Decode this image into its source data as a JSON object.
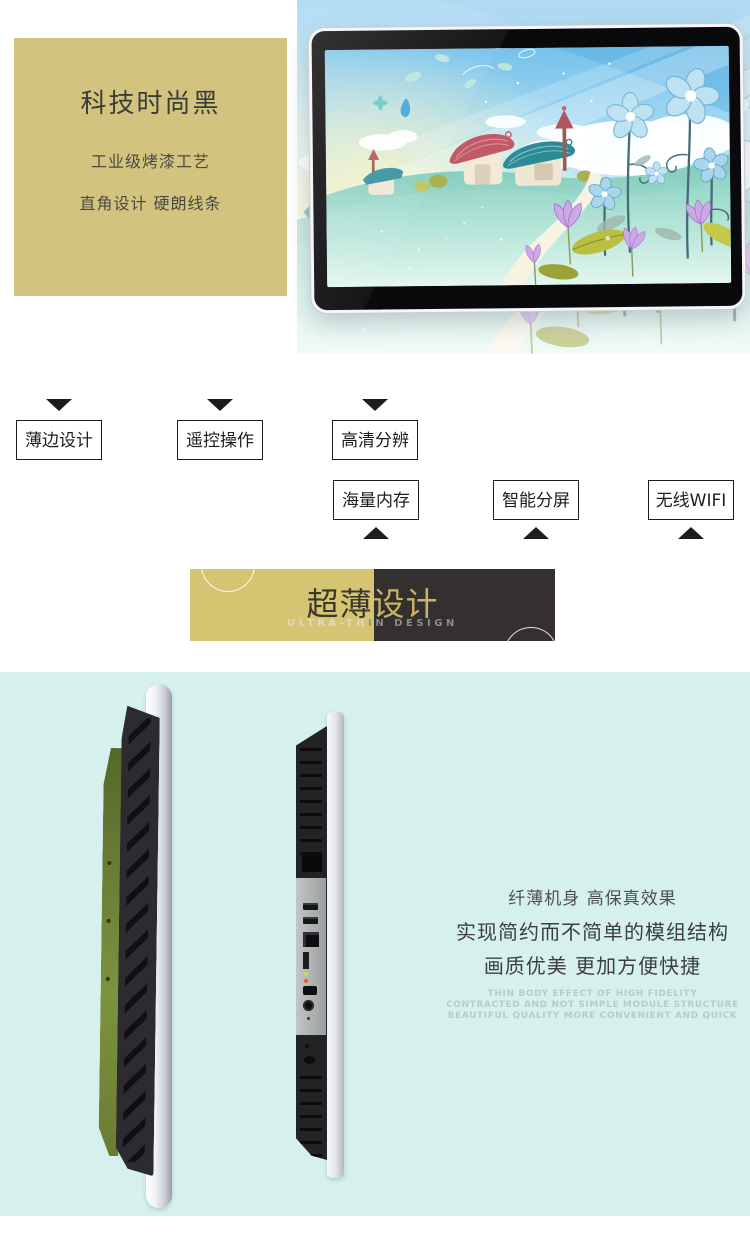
{
  "hero": {
    "title": "科技时尚黑",
    "line1": "工业级烤漆工艺",
    "line2": "直角设计 硬朗线条"
  },
  "features": {
    "row1": [
      {
        "label": "薄边设计"
      },
      {
        "label": "遥控操作"
      },
      {
        "label": "高清分辨"
      }
    ],
    "row2": [
      {
        "label": "海量内存"
      },
      {
        "label": "智能分屏"
      },
      {
        "label": "无线WIFI"
      }
    ]
  },
  "banner": {
    "title": "超薄设计",
    "subtitle": "ULTRA-THIN DESIGN"
  },
  "slim": {
    "line1": "纤薄机身 高保真效果",
    "line2": "实现简约而不简单的模组结构",
    "line3": "画质优美 更加方便快捷",
    "en1": "THIN BODY EFFECT OF HIGH FIDELITY",
    "en2": "CONTRACTED AND NOT SIMPLE MODULE STRUCTURE",
    "en3": "BEAUTIFUL QUALITY MORE CONVENIENT AND QUICK"
  },
  "icons": {
    "feature_pointer_down": "triangle-down",
    "feature_pointer_up": "triangle-up"
  },
  "colors": {
    "hero_panel": "#d2c47f",
    "banner_gold": "#d5c573",
    "banner_dark": "#34302f",
    "slim_section_bg": "#d6f1ed",
    "feature_border": "#1c1c1c",
    "tablet_frame": "#0a0a0c"
  }
}
